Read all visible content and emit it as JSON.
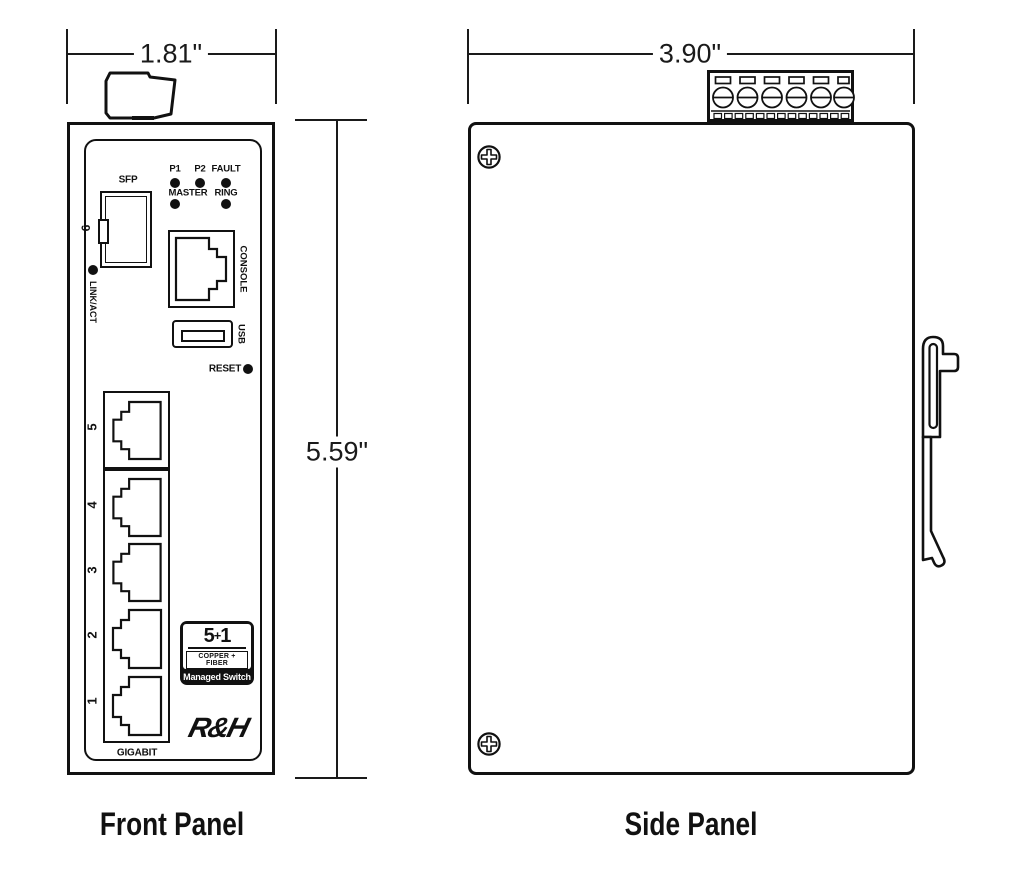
{
  "front": {
    "caption": "Front Panel",
    "dim_width": "1.81\"",
    "dim_height": "5.59\"",
    "led_labels": {
      "p1": "P1",
      "p2": "P2",
      "fault": "FAULT",
      "master": "MASTER",
      "ring": "RING"
    },
    "sfp": {
      "label": "SFP",
      "port": "6",
      "link_act": "LINK/ACT"
    },
    "console_label": "CONSOLE",
    "usb_label": "USB",
    "reset_label": "RESET",
    "port_numbers": [
      "5",
      "4",
      "3",
      "2",
      "1"
    ],
    "badge": {
      "count": "5",
      "plus": "+",
      "uplink": "1",
      "media": "COPPER + FIBER",
      "type": "Managed Switch"
    },
    "brand": "R&H",
    "speed_label": "GIGABIT"
  },
  "side": {
    "caption": "Side Panel",
    "dim_width": "3.90\""
  }
}
